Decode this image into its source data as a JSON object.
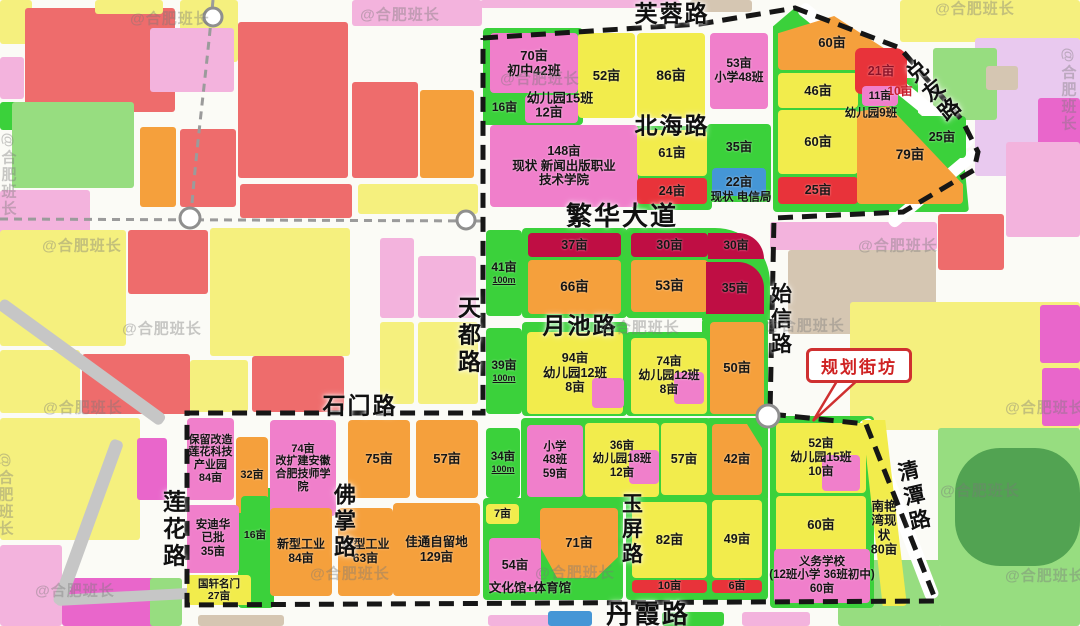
{
  "watermark_text": "@合肥班长",
  "colors": {
    "pink": "#f07fcb",
    "pinkl": "#f3b3dd",
    "magenta": "#e966cb",
    "yellow": "#f2ec4c",
    "lyellow": "#f5f07e",
    "orange": "#f5a03c",
    "salmon": "#ee6c6c",
    "red": "#e8333a",
    "darkred": "#bf0e44",
    "green": "#3bd13b",
    "lgreen": "#97dd80",
    "dgreen": "#52a352",
    "blue": "#4596d6",
    "tan": "#d5c6b2",
    "lavender": "#e9c9ef",
    "gray": "#c6c6c6",
    "boundary": "#161616",
    "callout_red": "#cf3030"
  },
  "blocks": [
    [
      0,
      0,
      32,
      44,
      "lyellow"
    ],
    [
      25,
      8,
      150,
      104,
      "salmon"
    ],
    [
      95,
      0,
      68,
      14,
      "lyellow"
    ],
    [
      180,
      0,
      58,
      62,
      "lyellow"
    ],
    [
      238,
      22,
      110,
      156,
      "salmon"
    ],
    [
      150,
      28,
      84,
      64,
      "pinkl"
    ],
    [
      352,
      82,
      66,
      96,
      "salmon"
    ],
    [
      420,
      90,
      54,
      88,
      "orange"
    ],
    [
      352,
      0,
      130,
      26,
      "pinkl"
    ],
    [
      0,
      57,
      24,
      42,
      "pinkl"
    ],
    [
      0,
      102,
      30,
      28,
      "green"
    ],
    [
      12,
      102,
      122,
      86,
      "lgreen"
    ],
    [
      0,
      190,
      90,
      60,
      "pinkl"
    ],
    [
      140,
      127,
      36,
      80,
      "orange"
    ],
    [
      180,
      129,
      56,
      78,
      "salmon"
    ],
    [
      240,
      184,
      112,
      34,
      "salmon"
    ],
    [
      358,
      184,
      120,
      30,
      "lyellow"
    ],
    [
      0,
      230,
      126,
      116,
      "lyellow"
    ],
    [
      128,
      230,
      80,
      64,
      "salmon"
    ],
    [
      210,
      228,
      140,
      128,
      "lyellow"
    ],
    [
      380,
      238,
      34,
      80,
      "pinkl"
    ],
    [
      418,
      256,
      58,
      62,
      "pinkl"
    ],
    [
      380,
      322,
      34,
      82,
      "lyellow"
    ],
    [
      418,
      322,
      60,
      82,
      "lyellow"
    ],
    [
      0,
      350,
      80,
      63,
      "lyellow"
    ],
    [
      82,
      354,
      108,
      60,
      "salmon"
    ],
    [
      190,
      360,
      58,
      52,
      "lyellow"
    ],
    [
      252,
      356,
      92,
      56,
      "salmon"
    ],
    [
      0,
      418,
      140,
      122,
      "lyellow"
    ],
    [
      137,
      438,
      30,
      62,
      "magenta"
    ],
    [
      0,
      545,
      62,
      81,
      "pinkl"
    ],
    [
      62,
      578,
      100,
      48,
      "magenta"
    ],
    [
      150,
      578,
      32,
      48,
      "lgreen"
    ],
    [
      198,
      615,
      86,
      11,
      "tan"
    ],
    [
      488,
      615,
      64,
      11,
      "pinkl"
    ],
    [
      548,
      611,
      44,
      15,
      "blue"
    ],
    [
      662,
      612,
      62,
      14,
      "green"
    ],
    [
      742,
      612,
      68,
      14,
      "pinkl"
    ],
    [
      900,
      0,
      180,
      42,
      "lyellow"
    ],
    [
      975,
      38,
      105,
      138,
      "lavender"
    ],
    [
      933,
      48,
      64,
      72,
      "lgreen"
    ],
    [
      986,
      66,
      32,
      24,
      "tan"
    ],
    [
      1038,
      98,
      42,
      58,
      "magenta"
    ],
    [
      1006,
      142,
      74,
      95,
      "pinkl"
    ],
    [
      770,
      222,
      167,
      28,
      "pinkl"
    ],
    [
      788,
      250,
      148,
      84,
      "tan"
    ],
    [
      938,
      214,
      66,
      56,
      "salmon"
    ],
    [
      850,
      302,
      230,
      128,
      "lyellow"
    ],
    [
      1040,
      305,
      40,
      58,
      "magenta"
    ],
    [
      1042,
      368,
      38,
      58,
      "magenta"
    ],
    [
      938,
      428,
      142,
      198,
      "lgreen"
    ],
    [
      838,
      560,
      104,
      66,
      "lgreen"
    ],
    [
      955,
      448,
      125,
      118,
      "dgreen",
      45
    ],
    [
      690,
      0,
      62,
      12,
      "tan"
    ],
    [
      480,
      0,
      200,
      8,
      "pinkl"
    ]
  ],
  "pads": [
    {
      "x": 483,
      "y": 28,
      "w": 100,
      "h": 97
    },
    {
      "x": 522,
      "y": 228,
      "w": 105,
      "h": 90
    },
    {
      "x": 626,
      "y": 228,
      "w": 87,
      "h": 90
    },
    {
      "x": 702,
      "y": 228,
      "w": 68,
      "h": 92,
      "r": "0 55px 0 0"
    },
    {
      "x": 522,
      "y": 322,
      "w": 105,
      "h": 94
    },
    {
      "x": 626,
      "y": 332,
      "w": 87,
      "h": 84
    },
    {
      "x": 702,
      "y": 318,
      "w": 66,
      "h": 98
    },
    {
      "x": 632,
      "y": 126,
      "w": 80,
      "h": 84
    },
    {
      "x": 707,
      "y": 124,
      "w": 64,
      "h": 78
    },
    {
      "x": 521,
      "y": 418,
      "w": 190,
      "h": 84
    },
    {
      "x": 706,
      "y": 418,
      "w": 62,
      "h": 84
    },
    {
      "x": 483,
      "y": 498,
      "w": 140,
      "h": 102
    },
    {
      "x": 626,
      "y": 496,
      "w": 86,
      "h": 104
    },
    {
      "x": 706,
      "y": 496,
      "w": 62,
      "h": 104
    },
    {
      "x": 770,
      "y": 416,
      "w": 104,
      "h": 192
    },
    {
      "x": 773,
      "y": 8,
      "w": 196,
      "h": 204,
      "cp": "polygon(0 9%,11% 0,97% 70%,100% 100%,0 100%)"
    },
    {
      "x": 860,
      "y": 78,
      "w": 58,
      "h": 48
    },
    {
      "x": 238,
      "y": 488,
      "w": 36,
      "h": 120
    }
  ],
  "gray_roads": [
    {
      "x": 796,
      "y": 12,
      "w": 14,
      "h": 220,
      "rot": -51,
      "c": "white"
    },
    {
      "x": 972,
      "y": 148,
      "w": 12,
      "h": 112,
      "rot": 50,
      "c": "white"
    },
    {
      "x": 858,
      "y": 422,
      "w": 14,
      "h": 192,
      "rot": -21,
      "c": "white"
    },
    {
      "x": -4,
      "y": 308,
      "w": 13,
      "h": 202,
      "rot": -54,
      "c": "gray"
    },
    {
      "x": 112,
      "y": 438,
      "w": 13,
      "h": 175,
      "rot": 20,
      "c": "gray"
    },
    {
      "x": 55,
      "y": 595,
      "w": 140,
      "h": 11,
      "rot": -3,
      "c": "gray"
    }
  ],
  "parcels": [
    {
      "x": 490,
      "y": 33,
      "w": 88,
      "h": 60,
      "c": "pink",
      "t": "70亩\n初中42班",
      "fs": 13
    },
    {
      "x": 486,
      "y": 95,
      "w": 37,
      "h": 25,
      "c": "green",
      "t": "16亩",
      "fs": 12
    },
    {
      "x": 525,
      "y": 95,
      "w": 53,
      "h": 28,
      "c": "pink",
      "t": "",
      "chip": 1
    },
    {
      "x": 578,
      "y": 33,
      "w": 57,
      "h": 85,
      "c": "yellow",
      "t": "52亩",
      "fs": 13
    },
    {
      "x": 637,
      "y": 33,
      "w": 68,
      "h": 85,
      "c": "yellow",
      "t": "86亩",
      "fs": 14
    },
    {
      "x": 710,
      "y": 33,
      "w": 58,
      "h": 76,
      "c": "pink",
      "t": "53亩\n小学48班",
      "fs": 12
    },
    {
      "x": 778,
      "y": 16,
      "w": 108,
      "h": 54,
      "c": "orange",
      "t": "60亩",
      "fs": 13,
      "cp": "polygon(0 32%,52% 0,100% 62%,100% 100%,0 100%)"
    },
    {
      "x": 778,
      "y": 73,
      "w": 80,
      "h": 35,
      "c": "yellow",
      "t": "46亩",
      "fs": 13
    },
    {
      "x": 855,
      "y": 48,
      "w": 52,
      "h": 46,
      "c": "red",
      "t": "21亩",
      "fs": 12.5,
      "tc": "#8c1228",
      "r": "6px 12px 4px 6px"
    },
    {
      "x": 862,
      "y": 86,
      "w": 36,
      "h": 20,
      "c": "pink",
      "t": "11亩",
      "fs": 11
    },
    {
      "x": 918,
      "y": 116,
      "w": 48,
      "h": 42,
      "c": "green",
      "t": "25亩",
      "fs": 12.5
    },
    {
      "x": 778,
      "y": 110,
      "w": 80,
      "h": 64,
      "c": "yellow",
      "t": "60亩",
      "fs": 13
    },
    {
      "x": 778,
      "y": 177,
      "w": 80,
      "h": 27,
      "c": "red",
      "t": "25亩",
      "fs": 12.5
    },
    {
      "x": 857,
      "y": 106,
      "w": 106,
      "h": 98,
      "c": "orange",
      "t": "79亩",
      "fs": 13.5,
      "cp": "polygon(0 6%,30% 0,100% 80%,100% 100%,0 100%)"
    },
    {
      "x": 490,
      "y": 125,
      "w": 148,
      "h": 82,
      "c": "pink",
      "t": "148亩\n现状 新闻出版职业\n技术学院",
      "fs": 12.5
    },
    {
      "x": 637,
      "y": 130,
      "w": 70,
      "h": 46,
      "c": "yellow",
      "t": "61亩",
      "fs": 13
    },
    {
      "x": 637,
      "y": 178,
      "w": 70,
      "h": 26,
      "c": "red",
      "t": "24亩",
      "fs": 12.5
    },
    {
      "x": 712,
      "y": 128,
      "w": 54,
      "h": 38,
      "c": "green",
      "t": "35亩",
      "fs": 12.5
    },
    {
      "x": 712,
      "y": 168,
      "w": 54,
      "h": 28,
      "c": "blue",
      "t": "22亩",
      "fs": 12.5
    },
    {
      "x": 528,
      "y": 233,
      "w": 93,
      "h": 24,
      "c": "darkred",
      "t": "37亩",
      "fs": 12.5
    },
    {
      "x": 528,
      "y": 260,
      "w": 93,
      "h": 54,
      "c": "orange",
      "t": "66亩",
      "fs": 13.5
    },
    {
      "x": 631,
      "y": 233,
      "w": 77,
      "h": 24,
      "c": "darkred",
      "t": "30亩",
      "fs": 12.5
    },
    {
      "x": 631,
      "y": 260,
      "w": 77,
      "h": 52,
      "c": "orange",
      "t": "53亩",
      "fs": 13.5
    },
    {
      "x": 708,
      "y": 233,
      "w": 56,
      "h": 26,
      "c": "darkred",
      "t": "30亩",
      "fs": 12,
      "r": "0 40px 0 0"
    },
    {
      "x": 706,
      "y": 262,
      "w": 58,
      "h": 52,
      "c": "darkred",
      "t": "35亩",
      "fs": 12.5,
      "r": "0 26px 0 0"
    },
    {
      "x": 486,
      "y": 230,
      "w": 36,
      "h": 86,
      "c": "green",
      "t": "41亩\n100m",
      "fs": 12
    },
    {
      "x": 486,
      "y": 328,
      "w": 36,
      "h": 86,
      "c": "green",
      "t": "39亩\n100m",
      "fs": 12
    },
    {
      "x": 527,
      "y": 332,
      "w": 96,
      "h": 82,
      "c": "yellow",
      "t": "94亩\n幼儿园12班\n8亩",
      "fs": 12.5
    },
    {
      "x": 592,
      "y": 378,
      "w": 32,
      "h": 30,
      "c": "pink",
      "t": "",
      "chip": 1
    },
    {
      "x": 631,
      "y": 338,
      "w": 76,
      "h": 76,
      "c": "yellow",
      "t": "74亩\n幼儿园12班\n8亩",
      "fs": 12
    },
    {
      "x": 674,
      "y": 372,
      "w": 30,
      "h": 32,
      "c": "pink",
      "t": "",
      "chip": 1
    },
    {
      "x": 710,
      "y": 322,
      "w": 54,
      "h": 92,
      "c": "orange",
      "t": "50亩",
      "fs": 13
    },
    {
      "x": 187,
      "y": 418,
      "w": 47,
      "h": 82,
      "c": "pink",
      "t": "保留改造\n莲花科技\n产业园\n84亩",
      "fs": 11
    },
    {
      "x": 236,
      "y": 437,
      "w": 32,
      "h": 76,
      "c": "orange",
      "t": "32亩",
      "fs": 11
    },
    {
      "x": 270,
      "y": 420,
      "w": 66,
      "h": 96,
      "c": "pink",
      "t": "74亩\n改扩建安徽\n合肥技师学\n院",
      "fs": 11
    },
    {
      "x": 348,
      "y": 420,
      "w": 62,
      "h": 78,
      "c": "orange",
      "t": "75亩",
      "fs": 13
    },
    {
      "x": 416,
      "y": 420,
      "w": 62,
      "h": 78,
      "c": "orange",
      "t": "57亩",
      "fs": 13
    },
    {
      "x": 187,
      "y": 505,
      "w": 52,
      "h": 68,
      "c": "pink",
      "t": "安迪华\n已批\n35亩",
      "fs": 11.5
    },
    {
      "x": 241,
      "y": 496,
      "w": 28,
      "h": 78,
      "c": "green",
      "t": "16亩",
      "fs": 10.5
    },
    {
      "x": 187,
      "y": 575,
      "w": 64,
      "h": 30,
      "c": "yellow",
      "t": "国轩名门\n27亩",
      "fs": 10.5
    },
    {
      "x": 270,
      "y": 508,
      "w": 62,
      "h": 88,
      "c": "orange",
      "t": "新型工业\n84亩",
      "fs": 12
    },
    {
      "x": 338,
      "y": 508,
      "w": 55,
      "h": 88,
      "c": "orange",
      "t": "新型工业\n63亩",
      "fs": 12
    },
    {
      "x": 393,
      "y": 503,
      "w": 87,
      "h": 93,
      "c": "orange",
      "t": "佳通自留地\n129亩",
      "fs": 12.5
    },
    {
      "x": 486,
      "y": 428,
      "w": 34,
      "h": 70,
      "c": "green",
      "t": "34亩\n100m",
      "fs": 11.5
    },
    {
      "x": 527,
      "y": 425,
      "w": 56,
      "h": 72,
      "c": "pink",
      "t": "小学\n48班\n59亩",
      "fs": 11.5
    },
    {
      "x": 585,
      "y": 423,
      "w": 74,
      "h": 74,
      "c": "yellow",
      "t": "36亩\n幼儿园18班\n12亩",
      "fs": 11.5
    },
    {
      "x": 629,
      "y": 450,
      "w": 30,
      "h": 34,
      "c": "pink",
      "t": "",
      "chip": 1
    },
    {
      "x": 661,
      "y": 423,
      "w": 46,
      "h": 72,
      "c": "yellow",
      "t": "57亩",
      "fs": 12.5
    },
    {
      "x": 712,
      "y": 424,
      "w": 50,
      "h": 71,
      "c": "orange",
      "t": "42亩",
      "fs": 12.5,
      "cp": "polygon(0 0,70% 0,100% 34%,100% 100%,0 100%)"
    },
    {
      "x": 486,
      "y": 504,
      "w": 33,
      "h": 20,
      "c": "yellow",
      "t": "7亩",
      "fs": 11
    },
    {
      "x": 540,
      "y": 508,
      "w": 78,
      "h": 70,
      "c": "orange",
      "t": "71亩",
      "fs": 13,
      "cp": "polygon(0 0,100% 0,100% 70%,72% 100%,22% 100%,0 55%)"
    },
    {
      "x": 489,
      "y": 538,
      "w": 52,
      "h": 54,
      "c": "pink",
      "t": "54亩",
      "fs": 12.5
    },
    {
      "x": 632,
      "y": 502,
      "w": 75,
      "h": 76,
      "c": "yellow",
      "t": "82亩",
      "fs": 13
    },
    {
      "x": 632,
      "y": 580,
      "w": 75,
      "h": 13,
      "c": "red",
      "t": "10亩",
      "fs": 11
    },
    {
      "x": 712,
      "y": 500,
      "w": 50,
      "h": 78,
      "c": "yellow",
      "t": "49亩",
      "fs": 12.5
    },
    {
      "x": 712,
      "y": 580,
      "w": 50,
      "h": 13,
      "c": "red",
      "t": "6亩",
      "fs": 11
    },
    {
      "x": 843,
      "y": 420,
      "w": 64,
      "h": 186,
      "c": "yellow",
      "t": "",
      "cp": "polygon(30% 0,66% 0,100% 100%,62% 100%)"
    },
    {
      "x": 776,
      "y": 423,
      "w": 90,
      "h": 70,
      "c": "yellow",
      "t": "52亩\n幼儿园15班\n10亩",
      "fs": 12
    },
    {
      "x": 822,
      "y": 455,
      "w": 38,
      "h": 36,
      "c": "pink",
      "t": "",
      "chip": 1
    },
    {
      "x": 776,
      "y": 496,
      "w": 90,
      "h": 58,
      "c": "yellow",
      "t": "60亩",
      "fs": 13
    },
    {
      "x": 774,
      "y": 549,
      "w": 96,
      "h": 54,
      "c": "pink",
      "t": "义务学校\n(12班小学 36班初中)\n60亩",
      "fs": 11.5
    }
  ],
  "float_labels": [
    {
      "x": 560,
      "y": 99,
      "t": "幼儿园15班",
      "fs": 13
    },
    {
      "x": 549,
      "y": 113,
      "t": "12亩",
      "fs": 13
    },
    {
      "x": 871,
      "y": 114,
      "t": "幼儿园9班",
      "fs": 11.5
    },
    {
      "x": 900,
      "y": 92,
      "t": "10亩",
      "fs": 12,
      "c": "#c51f2e"
    },
    {
      "x": 741,
      "y": 198,
      "t": "现状 电信局",
      "fs": 11.5
    },
    {
      "x": 530,
      "y": 588,
      "t": "文化馆+体育馆",
      "fs": 12.5
    },
    {
      "x": 884,
      "y": 528,
      "t": "南艳\n湾现\n状\n80亩",
      "fs": 12.5
    }
  ],
  "road_labels": [
    {
      "t": "芙蓉路",
      "x": 672,
      "y": 14,
      "o": "h",
      "fs": 23
    },
    {
      "t": "北海路",
      "x": 672,
      "y": 126,
      "o": "h",
      "fs": 23
    },
    {
      "t": "繁华大道",
      "x": 622,
      "y": 216,
      "o": "h",
      "fs": 26
    },
    {
      "t": "月池路",
      "x": 580,
      "y": 326,
      "o": "h",
      "fs": 23
    },
    {
      "t": "石门路",
      "x": 360,
      "y": 406,
      "o": "h",
      "fs": 23
    },
    {
      "t": "丹霞路",
      "x": 648,
      "y": 614,
      "o": "h",
      "fs": 26
    },
    {
      "t": "天都路",
      "x": 467,
      "y": 336,
      "o": "v",
      "fs": 23
    },
    {
      "t": "始信路",
      "x": 780,
      "y": 320,
      "o": "v",
      "fs": 21
    },
    {
      "t": "莲花路",
      "x": 172,
      "y": 530,
      "o": "v",
      "fs": 23
    },
    {
      "t": "佛掌路",
      "x": 343,
      "y": 522,
      "o": "v",
      "fs": 22
    },
    {
      "t": "玉屏路",
      "x": 631,
      "y": 530,
      "o": "v",
      "fs": 21
    },
    {
      "t": "兑友路",
      "x": 933,
      "y": 92,
      "o": "v",
      "fs": 21,
      "rot": -40
    },
    {
      "t": "清潭路",
      "x": 913,
      "y": 497,
      "o": "v",
      "fs": 21,
      "rot": -13
    }
  ],
  "watermarks": [
    [
      170,
      18
    ],
    [
      400,
      14
    ],
    [
      975,
      8
    ],
    [
      540,
      78
    ],
    [
      82,
      245
    ],
    [
      162,
      328
    ],
    [
      640,
      327
    ],
    [
      898,
      245
    ],
    [
      83,
      407
    ],
    [
      805,
      325
    ],
    [
      980,
      490
    ],
    [
      1045,
      407
    ],
    [
      1045,
      575
    ],
    [
      575,
      572
    ],
    [
      350,
      573
    ],
    [
      75,
      590
    ],
    [
      8,
      175,
      90
    ],
    [
      5,
      495,
      90
    ],
    [
      1068,
      90,
      90
    ]
  ],
  "boundary": {
    "points": "483,38 700,24 795,8 900,48 962,120 978,152 974,170 903,212 774,218 770,414 866,424 936,601 187,605 187,413 483,413 483,38"
  },
  "metro": {
    "paths": [
      "M213,0 C206,75 196,150 191,216",
      "M0,219 L481,221"
    ],
    "stations": [
      [
        213,
        17,
        9
      ],
      [
        190,
        218,
        10
      ],
      [
        466,
        220,
        9
      ],
      [
        768,
        416,
        11
      ]
    ]
  },
  "callout": {
    "label": "规划街坊",
    "x": 806,
    "y": 348,
    "w": 100,
    "h": 29,
    "arrow": "840,376 862,376 813,421"
  }
}
